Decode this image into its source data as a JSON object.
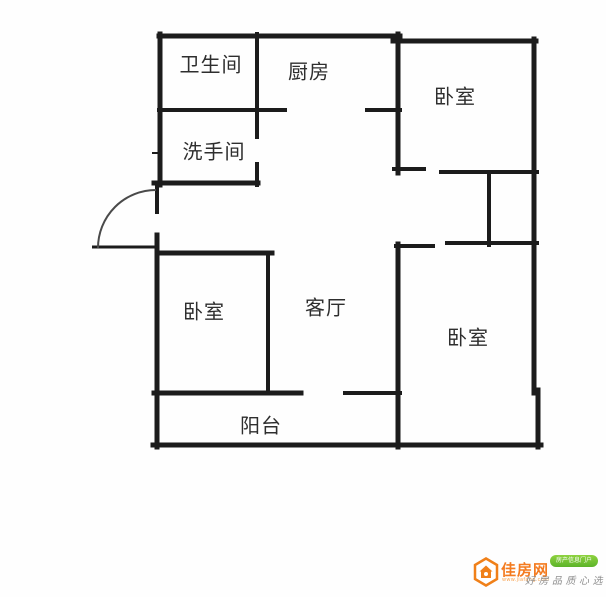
{
  "floorplan": {
    "wall_color": "#1c1c1c",
    "rooms": {
      "bathroom": "卫生间",
      "kitchen": "厨房",
      "bedroom_top_right": "卧室",
      "washroom": "洗手间",
      "bedroom_left": "卧室",
      "living_room": "客厅",
      "bedroom_right": "卧室",
      "balcony": "阳台"
    }
  },
  "watermark": {
    "brand": "佳房网",
    "url": "www.jiafang.com",
    "badge": "房产信息门户",
    "slogan": "好房品质心选",
    "brand_color": "#f47b20",
    "badge_color": "#67b82e",
    "slogan_color": "#8f8f8f"
  }
}
